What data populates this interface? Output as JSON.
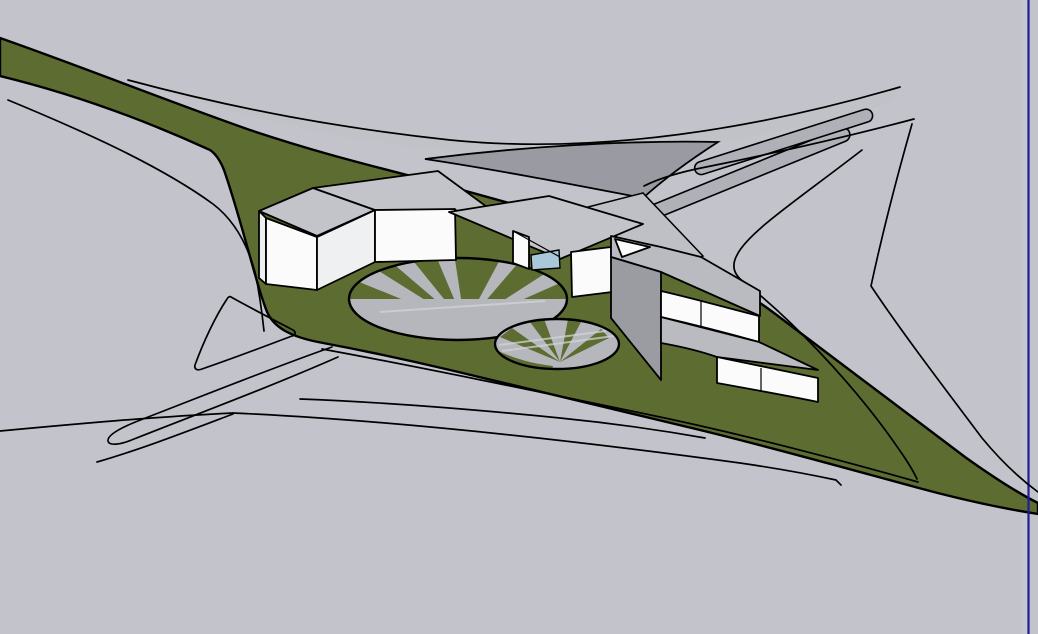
{
  "viewport": {
    "background": "#c3c4cb",
    "right_column": "#cbccd2",
    "axis_color": "#221b9a"
  },
  "palette": {
    "background": "#c3c4cb",
    "right_column": "#cbccd2",
    "axis_color": "#221b9a",
    "outline": "#000000",
    "site_green": "#5d6c30",
    "road_band": "#bfc0c6",
    "road_strip": "#b0b1b8",
    "road_dark": "#999aa2",
    "roof": "#c3c4c9",
    "roof_dark": "#babbc0",
    "wall": "#fbfbfb",
    "wall_shade": "#eef0f1",
    "side": "#9b9ca1",
    "glass": "#a9c8da",
    "plaza_gray": "#b6b7bd",
    "streak": "#d2d3d8"
  },
  "scene": {
    "terrain": {
      "name": "interchange-green-island",
      "color": "#5d6c30"
    },
    "roads": {
      "name": "highway-ramp-linework",
      "line_color": "#000000"
    },
    "buildings": [
      {
        "name": "bent-bar-building",
        "walls": "#fbfbfb",
        "roof": "#c3c4c9"
      },
      {
        "name": "canopy-pavilion",
        "walls": "#fbfbfb",
        "roof": "#c3c4c9",
        "glazing": "#a9c8da"
      },
      {
        "name": "stepped-terrace-building",
        "walls": "#fbfbfb",
        "roof": "#babbc0",
        "side": "#9b9ca1"
      }
    ],
    "plazas": [
      {
        "name": "large-radial-plaza",
        "base": "#5d6c30",
        "rays": "#b6b7bd",
        "ray_count": 5
      },
      {
        "name": "small-radial-plaza",
        "base": "#b6b7bd",
        "rays": "#5d6c30",
        "ray_count": 4
      }
    ],
    "axis_guide": {
      "name": "vertical-axis-guide",
      "color": "#221b9a"
    }
  }
}
